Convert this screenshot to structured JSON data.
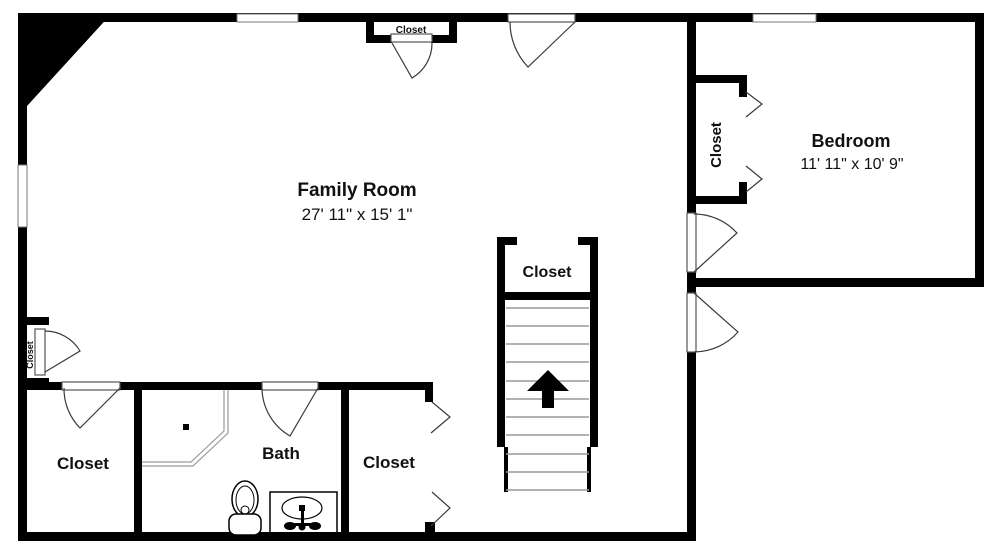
{
  "plan": {
    "background": "#ffffff",
    "wall_color": "#000000",
    "door_line_color": "#3a3a3a",
    "tread_color": "#999999",
    "shower_line_color": "#9a9a9a",
    "rooms": {
      "family_room": {
        "name": "Family Room",
        "dimensions": "27' 11\" x 15' 1\""
      },
      "bedroom": {
        "name": "Bedroom",
        "dimensions": "11' 11\" x 10' 9\""
      },
      "bath": {
        "name": "Bath"
      },
      "closet_top": {
        "name": "Closet"
      },
      "closet_bedroom": {
        "name": "Closet"
      },
      "closet_stairs": {
        "name": "Closet"
      },
      "closet_left_small": {
        "name": "Closet"
      },
      "closet_bottom_left": {
        "name": "Closet"
      },
      "closet_bottom_middle": {
        "name": "Closet"
      }
    },
    "stairs": {
      "direction": "up"
    }
  }
}
